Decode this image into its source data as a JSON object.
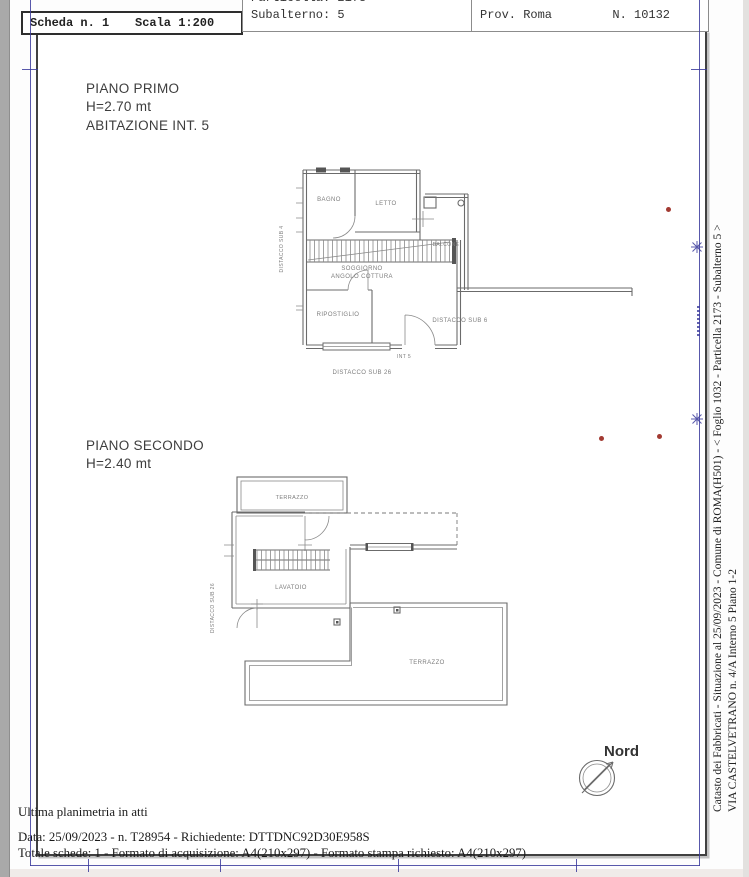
{
  "doc": {
    "header": {
      "scheda": "Scheda n. 1",
      "scala": "Scala 1:200",
      "particella_clipped": "Particella: 2173",
      "subalterno": "Subalterno: 5",
      "provincia": "Prov. Roma",
      "numero": "N. 10132"
    },
    "piano_primo": {
      "title": "PIANO PRIMO",
      "altezza": "H=2.70 mt",
      "subtitle": "ABITAZIONE INT. 5",
      "rooms": {
        "bagno": "BAGNO",
        "letto": "LETTO",
        "balcone": "BALCONE",
        "soggiorno_line1": "SOGGIORNO",
        "soggiorno_line2": "ANGOLO COTTURA",
        "ripostiglio": "RIPOSTIGLIO"
      },
      "annotations": {
        "distacco_sub_4": "DISTACCO SUB 4",
        "distacco_sub_6": "DISTACCO SUB 6",
        "distacco_sub_26": "DISTACCO SUB 26",
        "int_5": "INT 5"
      }
    },
    "piano_secondo": {
      "title": "PIANO SECONDO",
      "altezza": "H=2.40 mt",
      "rooms": {
        "terrazzo_piccolo": "TERRAZZO",
        "lavatoio": "LAVATOIO",
        "terrazzo_grande": "TERRAZZO"
      },
      "annotations": {
        "distacco_sub_26": "DISTACCO SUB 26"
      }
    },
    "compass": {
      "label": "Nord"
    },
    "footer": {
      "line1": "Ultima planimetria in atti",
      "line2": "Data: 25/09/2023 - n. T28954 - Richiedente: DTTDNC92D30E958S",
      "line3": "Totale schede: 1 - Formato di acquisizione: A4(210x297)  - Formato stampa richiesto: A4(210x297)"
    },
    "side_text": {
      "line1": "Catasto dei Fabbricati - Situazione al 25/09/2023 - Comune di ROMA(H501) - < Foglio 1032 - Particella 2173 - Subalterno 5 >",
      "line2": "VIA CASTELVETRANO n. 4/A  Interno 5 Piano 1-2"
    },
    "colors": {
      "registration_blue": "#3b3b9c",
      "mark_red": "#a23a32"
    }
  }
}
